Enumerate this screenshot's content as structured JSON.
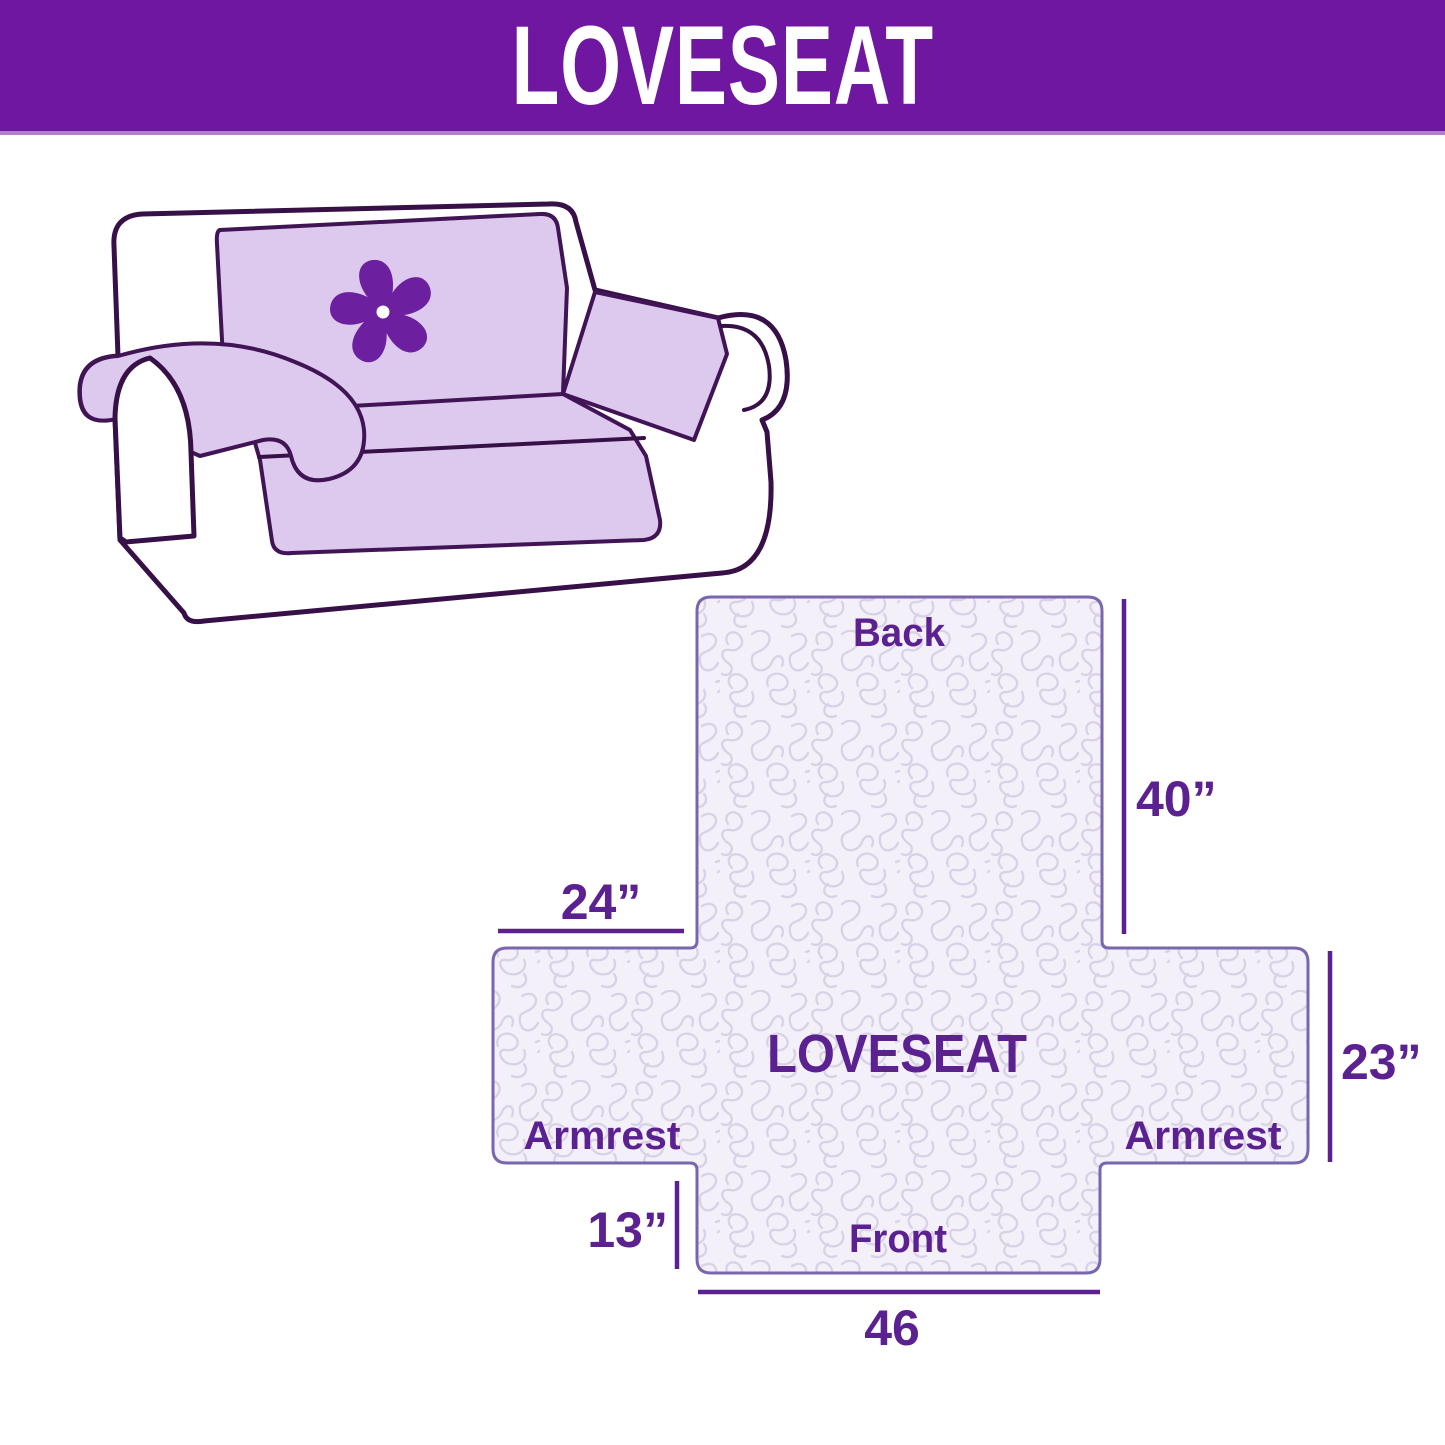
{
  "header": {
    "title": "LOVESEAT"
  },
  "illustration": {
    "alt": "loveseat sofa with lavender quilted cover and pinwheel logo",
    "logo_icon": "pinwheel-icon"
  },
  "diagram": {
    "labels": {
      "back": "Back",
      "center": "LOVESEAT",
      "armrest_left": "Armrest",
      "armrest_right": "Armrest",
      "front": "Front"
    },
    "dimensions": {
      "back_height": "40”",
      "armrest_top_width": "24”",
      "side_height": "23”",
      "front_drop": "13”",
      "front_width": "46"
    }
  },
  "colors": {
    "header_bg": "#6F17A0",
    "header_text": "#FFFFFF",
    "accent_text": "#5C2190",
    "cover_fill": "#DEC9EE",
    "sofa_outline": "#371048",
    "pattern_bg": "#F3F0F9",
    "pattern_line": "#D9D2E6",
    "diagram_outline": "#7A66AE",
    "logo": "#6C1F9F"
  }
}
